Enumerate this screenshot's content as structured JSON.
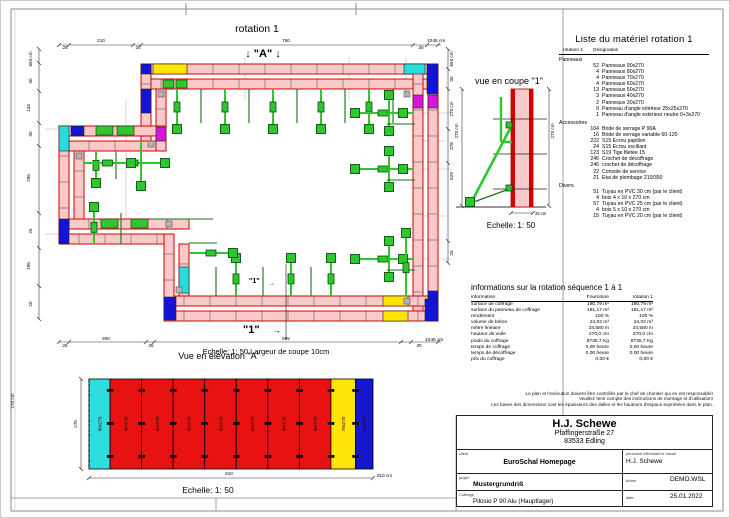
{
  "plan": {
    "title": "rotation 1",
    "marker_a": "↓ \"A\" ↓",
    "marker_1": "\"1\"",
    "arrow_right": "→",
    "scale_note": "Echelle: 1: 50   Largeur de coupe 10cm",
    "dims": {
      "top": [
        "25",
        "210",
        "20",
        "760",
        "30"
      ],
      "top_total": "1045 cm",
      "bottom": [
        "25",
        "300",
        "25",
        "665",
        "30"
      ],
      "bottom_total": "1045 cm",
      "left": [
        "30",
        "134",
        "30",
        "295",
        "25",
        "195",
        "25"
      ],
      "left_total": "694 cm",
      "right": [
        "30",
        "270 cm",
        "376",
        "629",
        "25"
      ],
      "right_total": "694 cm"
    }
  },
  "section": {
    "title": "vue en coupe \"1\"",
    "scale": "Echelle: 1: 50",
    "dim_left": "270 cm",
    "dim_right": "270 cm",
    "dim_bottom": "25 cm"
  },
  "material_list": {
    "title": "Liste du matériel  rotation 1",
    "header": {
      "col1": "rotation 1",
      "col2": "Désignation"
    },
    "groups": [
      {
        "name": "Panneaux",
        "items": [
          {
            "qty": "52",
            "label": "Panneaux 90x270"
          },
          {
            "qty": "4",
            "label": "Panneaux 80x270"
          },
          {
            "qty": "4",
            "label": "Panneaux 70x270"
          },
          {
            "qty": "4",
            "label": "Panneaux 60x270"
          },
          {
            "qty": "13",
            "label": "Panneaux 50x270"
          },
          {
            "qty": "3",
            "label": "Panneaux 40x270"
          },
          {
            "qty": "2",
            "label": "Panneaux 30x270"
          },
          {
            "qty": "9",
            "label": "Panneau d'angle intérieur 25x25x270"
          },
          {
            "qty": "1",
            "label": "Panneau d'angle extérieur neutre 0+3x270"
          }
        ]
      },
      {
        "name": "Accessoires",
        "items": [
          {
            "qty": "104",
            "label": "Bride de serrage P 90A"
          },
          {
            "qty": "16",
            "label": "Bride de serrage variable 60-120"
          },
          {
            "qty": "222",
            "label": "S15 Ecrou papillon"
          },
          {
            "qty": "24",
            "label": "S15 Ecrou oscillant"
          },
          {
            "qty": "123",
            "label": "S19 Tige filetée 15"
          },
          {
            "qty": "246",
            "label": "Crochet de décoffrage"
          },
          {
            "qty": "246",
            "label": "crochet de décoffrage"
          },
          {
            "qty": "22",
            "label": "Console de service"
          },
          {
            "qty": "21",
            "label": "Etai de plombage 210/350"
          }
        ]
      },
      {
        "name": "Divers",
        "items": [
          {
            "qty": "51",
            "label": "Tuyau en PVC 30 cm (par le client)"
          },
          {
            "qty": "4",
            "label": "bois 4 x 10 x 270 cm"
          },
          {
            "qty": "57",
            "label": "Tuyau en PVC 25 cm (par le client)"
          },
          {
            "qty": "4",
            "label": "bois 5 x 10 x 270 cm"
          },
          {
            "qty": "15",
            "label": "Tuyau en PVC 20 cm (par le client)"
          }
        ]
      }
    ]
  },
  "info_table": {
    "title": "informations sur la rotation  séquence 1 à 1",
    "columns": [
      "information",
      "Fourniture",
      "rotation 1"
    ],
    "rows": [
      [
        "surface de coffrage",
        "180,79 m²",
        "180,79 m²"
      ],
      [
        "surface du panneau de coffrage",
        "181,17 m²",
        "181,17 m²"
      ],
      [
        "rendement",
        "100 %",
        "100 %"
      ],
      [
        "volume de béton",
        "24,02 m³",
        "24,02 m³"
      ],
      [
        "mètre linéaire",
        "34,580 m",
        "34,580 m"
      ],
      [
        "hauteur de voile",
        "270,0 cm",
        "270,0 cm"
      ],
      [
        "poids du coffrage",
        "8735,7 Kg",
        "8735,7 Kg"
      ],
      [
        "temps de coffrage",
        "0,00 heure",
        "0,00 heure"
      ],
      [
        "temps de décoffrage",
        "0,00 heure",
        "0,00 heure"
      ],
      [
        "prix du coffrage",
        "0,00 €",
        "0,00 €"
      ]
    ]
  },
  "disclaimer": [
    "Le plan et l'exécution doivent être contrôlés par le chef de chantier qui en est responsable!",
    "Veuillez tenir compte des instructions de montage et d'utilisation!",
    "Les bases des dimensions sont les épaisseurs des dalles et les hauteurs d'espace exprimées dans le plan."
  ],
  "title_block": {
    "company": "H.J. Schewe",
    "address1": "Pfaffingerstraße 27",
    "address2": "83533 Edling",
    "client_label": "client",
    "client": "EuroSchal Homepage",
    "worker_label": "personne effectuant le travail",
    "worker": "H.J. Schewe",
    "project_label": "projet",
    "project": "Mustergrundriß",
    "file_label": "fichier",
    "file": "DEMO.WSL",
    "formwork_label": "Coffrage",
    "formwork": "Pilosio P 90 Alu (Hauptlager)",
    "date_label": "date",
    "date": "25.01.2022"
  },
  "elevation": {
    "title": "Vue en élévation \"A\"",
    "scale": "Echelle: 1: 50",
    "dim_height": "270",
    "dim_height_cm": "270 cm",
    "dim_width": "810",
    "dim_width_total": "810 cm",
    "panels": [
      {
        "label": "60x270",
        "color": "#2edede",
        "width": 60
      },
      {
        "label": "90x270",
        "color": "#e81212",
        "width": 90
      },
      {
        "label": "90x270",
        "color": "#e81212",
        "width": 90
      },
      {
        "label": "90x270",
        "color": "#e81212",
        "width": 90
      },
      {
        "label": "90x270",
        "color": "#e81212",
        "width": 90
      },
      {
        "label": "90x270",
        "color": "#e81212",
        "width": 90
      },
      {
        "label": "90x270",
        "color": "#e81212",
        "width": 90
      },
      {
        "label": "90x270",
        "color": "#e81212",
        "width": 90
      },
      {
        "label": "70x270",
        "color": "#ffe40a",
        "width": 70
      },
      {
        "label": "50x270",
        "color": "#1616cf",
        "width": 50
      }
    ]
  },
  "colors": {
    "wall_red": "#d40000",
    "panel_pink": "#f7c9c9",
    "green_bright": "#2ec82e",
    "green_dark": "#157015",
    "yellow": "#ffe400",
    "blue": "#1414d4",
    "cyan": "#28dcdc",
    "magenta": "#d816d8",
    "gray_piece": "#b4b4b4"
  }
}
